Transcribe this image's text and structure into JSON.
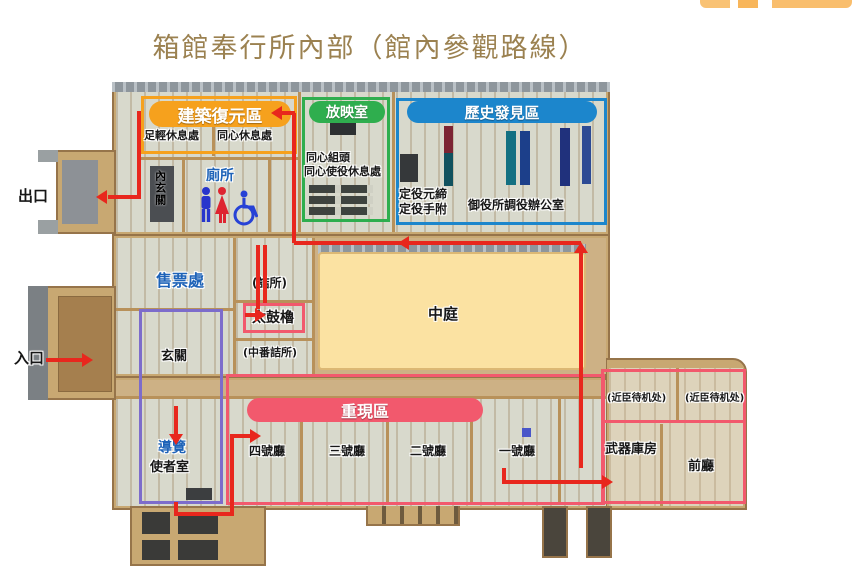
{
  "title": "箱館奉行所內部（館內參觀路線）",
  "zones": {
    "reconstruction": {
      "label": "建築復元區",
      "color": "#f6a11d"
    },
    "screening": {
      "label": "放映室",
      "color": "#2fae4e"
    },
    "history": {
      "label": "歷史發見區",
      "color": "#1c86cc"
    },
    "reenactment": {
      "label": "重現區",
      "color": "#f2596d"
    }
  },
  "rooms": {
    "ashigaru": "足輕休息處",
    "doshin_rest": "同心休息處",
    "inner_entrance": "內玄關",
    "toilet": "廁所",
    "doshin_kumigashira": "同心組頭",
    "doshin_shieki": "同心使役休息處",
    "sadayaku_motojime": "定役元締",
    "sadayaku_tetsuke": "定役手附",
    "office": "御役所調役辦公室",
    "tsumesho": "(詰所)",
    "taiko_yagura": "太鼓櫓",
    "nakaban_tsumesho": "(中番詰所)",
    "ticket_office": "售票處",
    "courtyard": "中庭",
    "genkan": "玄關",
    "guide": "導覽",
    "messenger_room": "使者室",
    "hall4": "四號廳",
    "hall3": "三號廳",
    "hall2": "二號廳",
    "hall1": "一號廳",
    "kinshin1": "(近臣待机处)",
    "kinshin2": "(近臣待机处)",
    "armory": "武器庫房",
    "front_hall": "前廳"
  },
  "outside": {
    "entrance": "入口",
    "exit": "出口"
  },
  "colors": {
    "route": "#e8271d",
    "purple_zone_border": "#7d6ccb",
    "pink_zone_border": "#f2596d",
    "courtyard_fill": "#fbe2a2",
    "building_wood": "#c8a872",
    "title_text": "#9b8150",
    "restroom_men": "#2735cc",
    "restroom_women": "#de2430",
    "restroom_wheelchair": "#2742d6"
  }
}
